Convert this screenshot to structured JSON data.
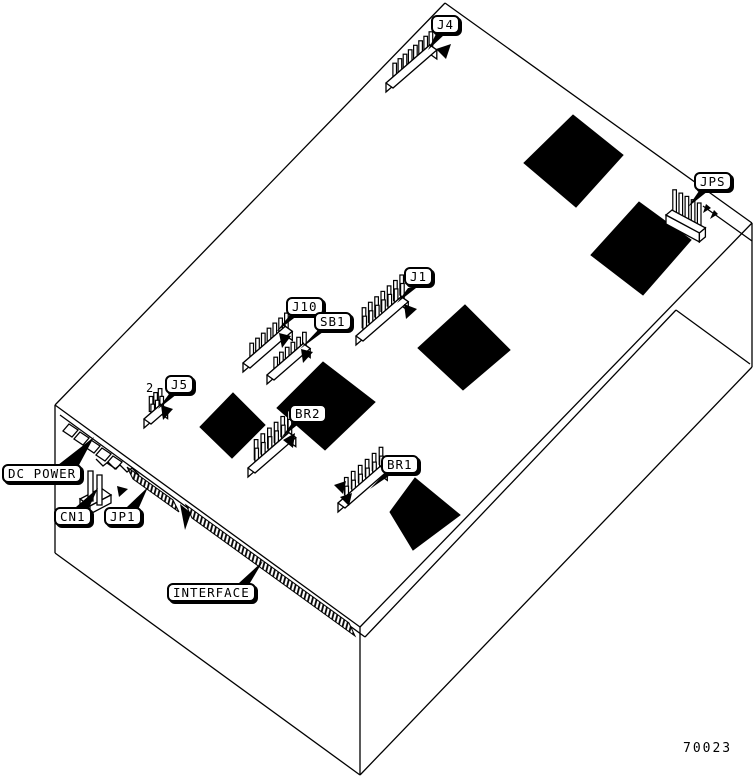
{
  "figure": {
    "number": "70023"
  },
  "markers": {
    "pin2_label": "2"
  },
  "callouts": [
    {
      "key": "j4",
      "text": "J4",
      "x": 431,
      "y": 15
    },
    {
      "key": "jps",
      "text": "JPS",
      "x": 694,
      "y": 172
    },
    {
      "key": "j1",
      "text": "J1",
      "x": 404,
      "y": 267
    },
    {
      "key": "j10",
      "text": "J10",
      "x": 286,
      "y": 297
    },
    {
      "key": "sb1",
      "text": "SB1",
      "x": 314,
      "y": 312
    },
    {
      "key": "j5",
      "text": "J5",
      "x": 165,
      "y": 375
    },
    {
      "key": "br2",
      "text": "BR2",
      "x": 289,
      "y": 404
    },
    {
      "key": "br1",
      "text": "BR1",
      "x": 381,
      "y": 455
    },
    {
      "key": "dc-power",
      "text": "DC POWER",
      "x": 2,
      "y": 464
    },
    {
      "key": "cn1",
      "text": "CN1",
      "x": 54,
      "y": 507
    },
    {
      "key": "jp1",
      "text": "JP1",
      "x": 104,
      "y": 507
    },
    {
      "key": "interface",
      "text": "INTERFACE",
      "x": 167,
      "y": 583
    }
  ],
  "diagram": {
    "outline_lines": [
      [
        445,
        3,
        752,
        223
      ],
      [
        445,
        3,
        55,
        405
      ],
      [
        55,
        405,
        360,
        627
      ],
      [
        360,
        627,
        752,
        223
      ],
      [
        55,
        405,
        55,
        553
      ],
      [
        55,
        553,
        360,
        775
      ],
      [
        360,
        627,
        360,
        775
      ],
      [
        360,
        775,
        752,
        367
      ],
      [
        752,
        223,
        752,
        367
      ],
      [
        60,
        415,
        365,
        637
      ],
      [
        365,
        637,
        676,
        310
      ],
      [
        676,
        310,
        750,
        364
      ],
      [
        703,
        206,
        752,
        241
      ]
    ],
    "ics": [
      {
        "name": "ic-chip-1",
        "points": "573,115 623,155 576,207 524,163"
      },
      {
        "name": "ic-chip-2",
        "points": "639,202 691,240 643,295 591,255"
      },
      {
        "name": "ic-chip-3",
        "points": "465,305 510,350 463,390 418,348"
      },
      {
        "name": "ic-chip-4",
        "points": "233,393 265,425 232,458 200,427"
      },
      {
        "name": "ic-chip-5",
        "points": "323,362 375,402 325,450 277,408"
      },
      {
        "name": "ic-chip-6",
        "points": "415,478 460,515 413,550 390,512"
      }
    ],
    "connectors": [
      {
        "key": "j4",
        "x": 386,
        "y": 92,
        "len": 58,
        "pins": 8,
        "rows": 1,
        "ph": 20,
        "dir": [
          0.755,
          -0.655
        ],
        "cap": [
          7,
          5
        ]
      },
      {
        "key": "jps",
        "x": 666,
        "y": 224,
        "len": 38,
        "pins": 5,
        "rows": 1,
        "ph": 24,
        "dir": [
          0.88,
          0.47
        ],
        "cap": [
          6,
          -5
        ]
      },
      {
        "key": "j10",
        "x": 243,
        "y": 372,
        "len": 56,
        "pins": 7,
        "rows": 1,
        "ph": 20,
        "dir": [
          0.755,
          -0.655
        ],
        "cap": [
          7,
          5
        ]
      },
      {
        "key": "sb1",
        "x": 267,
        "y": 384,
        "len": 48,
        "pins": 6,
        "rows": 1,
        "ph": 18,
        "dir": [
          0.755,
          -0.655
        ],
        "cap": [
          7,
          5
        ]
      },
      {
        "key": "j1",
        "x": 356,
        "y": 345,
        "len": 60,
        "pins": 7,
        "rows": 2,
        "ph": 20,
        "dir": [
          0.755,
          -0.655
        ],
        "cap": [
          7,
          5
        ]
      },
      {
        "key": "br2",
        "x": 248,
        "y": 477,
        "len": 54,
        "pins": 6,
        "rows": 2,
        "ph": 20,
        "dir": [
          0.755,
          -0.655
        ],
        "cap": [
          7,
          5
        ]
      },
      {
        "key": "br1",
        "x": 338,
        "y": 512,
        "len": 56,
        "pins": 6,
        "rows": 2,
        "ph": 17,
        "dir": [
          0.755,
          -0.655
        ],
        "cap": [
          7,
          5
        ]
      },
      {
        "key": "j5",
        "x": 144,
        "y": 428,
        "len": 22,
        "pins": 3,
        "rows": 2,
        "ph": 15,
        "dir": [
          0.755,
          -0.655
        ],
        "cap": [
          7,
          5
        ]
      }
    ],
    "strips": [
      {
        "name": "jp1-edge-connector",
        "points": "127,467 173,500 179,512 133,479"
      },
      {
        "name": "interface-edge-connector",
        "points": "186,505 349,623 355,636 192,518"
      }
    ],
    "misc_polys": [
      {
        "name": "cn1-base-top",
        "points": "80,499 101,488 111,495 90,506"
      },
      {
        "name": "cn1-base-front",
        "points": "80,499 90,506 90,514 80,507"
      },
      {
        "name": "cn1-base-right",
        "points": "90,506 111,495 111,503 90,514"
      },
      {
        "name": "cn1-prong-1",
        "points": "88,471 93,471 93,501 88,501"
      },
      {
        "name": "cn1-prong-2",
        "points": "97,475 102,475 102,505 97,505"
      },
      {
        "name": "dc-power-socket-1",
        "points": "69,424 78,430 72,437 63,431"
      },
      {
        "name": "dc-power-socket-2",
        "points": "80,432 89,438 83,445 74,439"
      },
      {
        "name": "dc-power-socket-3",
        "points": "91,440 100,446 94,453 85,447"
      },
      {
        "name": "dc-power-socket-4",
        "points": "102,448 111,454 105,461 96,455"
      },
      {
        "name": "dc-power-socket-5",
        "points": "113,456 122,462 116,469 107,463"
      }
    ],
    "pointers": [
      {
        "name": "j4-callout-pointer",
        "points": "436,34 445,34 428,50"
      },
      {
        "name": "j4-pin1-arrow",
        "points": "451,44 446,59 436,49"
      },
      {
        "name": "jps-callout-pointer",
        "points": "699,191 708,191 688,207"
      },
      {
        "name": "jps-pin1-tick-1",
        "points": "706,204 711,208 703,213"
      },
      {
        "name": "jps-pin1-tick-2",
        "points": "714,210 718,214 710,219"
      },
      {
        "name": "j10-callout-pointer",
        "points": "290,315 298,315 276,332"
      },
      {
        "name": "j10-pin1-arrow",
        "points": "279,333 291,336 282,348"
      },
      {
        "name": "sb1-callout-pointer",
        "points": "319,329 327,329 300,349"
      },
      {
        "name": "sb1-pin1-arrow",
        "points": "301,349 313,352 303,363"
      },
      {
        "name": "j1-callout-pointer",
        "points": "408,288 416,288 397,303"
      },
      {
        "name": "j1-pin1-arrow",
        "points": "404,304 417,309 406,319"
      },
      {
        "name": "j5-callout-pointer",
        "points": "169,394 177,394 158,409"
      },
      {
        "name": "j5-pin1-arrow",
        "points": "161,405 173,409 163,420"
      },
      {
        "name": "br2-callout-pointer",
        "points": "293,422 301,422 281,438"
      },
      {
        "name": "br2-pin1-arrow",
        "points": "283,440 295,433 293,448"
      },
      {
        "name": "br1-callout-pointer",
        "points": "385,473 393,473 370,489"
      },
      {
        "name": "br1-pin1-arrow-1",
        "points": "334,485 346,481 343,494"
      },
      {
        "name": "br1-pin1-arrow-2",
        "points": "340,497 352,493 349,506"
      },
      {
        "name": "dc-power-callout-pointer",
        "points": "58,465 79,465 94,437"
      },
      {
        "name": "cn1-callout-pointer",
        "points": "76,507 87,512 98,488"
      },
      {
        "name": "jp1-callout-pointer",
        "points": "127,507 137,512 148,487"
      },
      {
        "name": "jp1-pin1-arrow",
        "points": "117,486 128,489 119,497"
      },
      {
        "name": "interface-callout-pointer",
        "points": "239,583 247,588 263,561"
      },
      {
        "name": "interface-pin1-triangle",
        "points": "180,504 191,513 185,530"
      }
    ],
    "misc_paths": [
      {
        "name": "edge-step-outline",
        "d": "M96,459 l7,7 l5,-4 l7,7 l5,-4 l7,7 l5,-4 l7,7"
      },
      {
        "name": "pin2-leader-line",
        "d": "M153,397 q-4,6 2,10"
      }
    ]
  }
}
